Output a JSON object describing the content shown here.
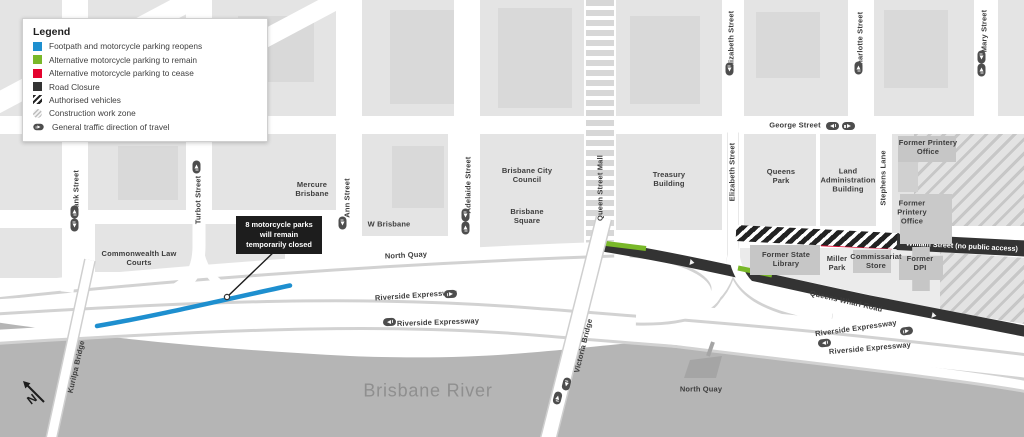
{
  "colors": {
    "reopens": "#1e8fcf",
    "remain": "#79b829",
    "cease": "#e4032e",
    "closure": "#333333",
    "river": "#b5b5b5"
  },
  "legend": {
    "title": "Legend",
    "items": [
      {
        "label": "Footpath and motorcycle parking reopens",
        "key": "reopens-square"
      },
      {
        "label": "Alternative motorcycle parking to remain",
        "key": "remain-square"
      },
      {
        "label": "Alternative motorcycle parking to cease",
        "key": "cease-square"
      },
      {
        "label": "Road Closure",
        "key": "closure-square"
      },
      {
        "label": "Authorised vehicles",
        "key": "black-white-hatch"
      },
      {
        "label": "Construction work zone",
        "key": "gray-hatch-circle"
      },
      {
        "label": "General traffic direction of travel",
        "key": "traffic-direction-pill"
      }
    ]
  },
  "callout": {
    "text": "8 motorcycle parks will remain temporarily closed"
  },
  "compass": {
    "label": "N"
  },
  "map": {
    "streets": {
      "tank": "Tank Street",
      "turbot": "Turbot Street",
      "ann": "Ann Street",
      "adelaide": "Adelaide Street",
      "queen_mall": "Queen Street Mall",
      "elizabeth": "Elizabeth Street",
      "charlotte": "Charlotte Street",
      "mary": "Mary Street",
      "george": "George Street",
      "stephens": "Stephens Lane",
      "north_quay": "North Quay",
      "riverside": "Riverside Expressway",
      "queens_wharf": "Queens Wharf Road",
      "william": "William Street (no public access)",
      "victoria_bridge": "Victoria Bridge",
      "kurilpa_bridge": "Kurilpa Bridge"
    },
    "places": {
      "mercure": "Mercure Brisbane",
      "w_brisbane": "W Brisbane",
      "bcc": "Brisbane City Council",
      "brisbane_square": "Brisbane Square",
      "treasury": "Treasury Building",
      "queens_park": "Queens Park",
      "land_admin": "Land Administration Building",
      "printery": "Former Printery Office",
      "law_courts": "Commonwealth Law Courts",
      "state_library": "Former State Library",
      "miller_park": "Miller Park",
      "commissariat": "Commissariat Store",
      "dpi": "Former DPI",
      "river": "Brisbane River",
      "north_quay_ferry": "North Quay"
    }
  }
}
